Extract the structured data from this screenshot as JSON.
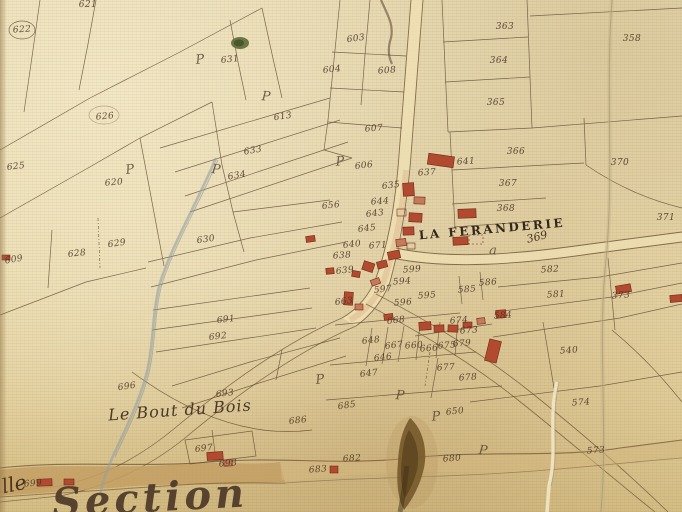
{
  "map": {
    "colors": {
      "parchment": "#e7d7a9",
      "ink": "#5f4930",
      "building_red": "#b24a30",
      "road_band": "#c9a76d",
      "stream_grey": "#93a0a4",
      "stain_brown": "#75592a",
      "foliage_green": "#5c6a36"
    },
    "region_labels": [
      {
        "name": "hamlet-label-la-feranderie",
        "t": "LA FERANDERIE",
        "x": 492,
        "y": 229,
        "r": -5,
        "kind": "caps"
      },
      {
        "name": "parcel-number-369",
        "t": "369",
        "x": 537,
        "y": 237,
        "r": -14,
        "kind": "num-lg"
      },
      {
        "name": "place-label-le-bout-du-bois",
        "t": "Le Bout du Bois",
        "x": 180,
        "y": 410,
        "r": -4,
        "kind": "script"
      },
      {
        "name": "section-label",
        "t": "Section",
        "x": 150,
        "y": 498,
        "r": -3,
        "kind": "script-xl"
      },
      {
        "name": "edge-label-lle",
        "t": "lle",
        "x": 14,
        "y": 484,
        "r": -12,
        "kind": "script-lg"
      }
    ],
    "parcel_numbers": [
      {
        "t": "622",
        "x": 22,
        "y": 30,
        "r": -4
      },
      {
        "t": "621",
        "x": 88,
        "y": 5,
        "r": 0
      },
      {
        "t": "363",
        "x": 505,
        "y": 27,
        "r": 0
      },
      {
        "t": "364",
        "x": 499,
        "y": 61,
        "r": 0
      },
      {
        "t": "365",
        "x": 496,
        "y": 103,
        "r": 0
      },
      {
        "t": "358",
        "x": 632,
        "y": 39,
        "r": 0
      },
      {
        "t": "631",
        "x": 230,
        "y": 60,
        "r": -6
      },
      {
        "t": "603",
        "x": 356,
        "y": 39,
        "r": -8
      },
      {
        "t": "604",
        "x": 332,
        "y": 70,
        "r": -6
      },
      {
        "t": "608",
        "x": 387,
        "y": 71,
        "r": -4
      },
      {
        "t": "626",
        "x": 105,
        "y": 117,
        "r": -5
      },
      {
        "t": "613",
        "x": 283,
        "y": 117,
        "r": -8
      },
      {
        "t": "607",
        "x": 374,
        "y": 129,
        "r": -5
      },
      {
        "t": "366",
        "x": 516,
        "y": 152,
        "r": 0
      },
      {
        "t": "370",
        "x": 620,
        "y": 163,
        "r": 0
      },
      {
        "t": "625",
        "x": 16,
        "y": 167,
        "r": -6
      },
      {
        "t": "620",
        "x": 114,
        "y": 183,
        "r": -5
      },
      {
        "t": "633",
        "x": 253,
        "y": 151,
        "r": -10
      },
      {
        "t": "634",
        "x": 237,
        "y": 176,
        "r": -10
      },
      {
        "t": "606",
        "x": 364,
        "y": 166,
        "r": -6
      },
      {
        "t": "367",
        "x": 508,
        "y": 184,
        "r": 0
      },
      {
        "t": "368",
        "x": 506,
        "y": 209,
        "r": 0
      },
      {
        "t": "371",
        "x": 666,
        "y": 218,
        "r": 0
      },
      {
        "t": "641",
        "x": 466,
        "y": 162,
        "r": -4
      },
      {
        "t": "637",
        "x": 427,
        "y": 173,
        "r": -4
      },
      {
        "t": "635",
        "x": 391,
        "y": 186,
        "r": -6
      },
      {
        "t": "656",
        "x": 331,
        "y": 206,
        "r": -6
      },
      {
        "t": "644",
        "x": 380,
        "y": 202,
        "r": -4
      },
      {
        "t": "643",
        "x": 375,
        "y": 214,
        "r": -6
      },
      {
        "t": "645",
        "x": 367,
        "y": 229,
        "r": -6
      },
      {
        "t": "630",
        "x": 206,
        "y": 240,
        "r": -8
      },
      {
        "t": "628",
        "x": 77,
        "y": 254,
        "r": -6
      },
      {
        "t": "629",
        "x": 117,
        "y": 244,
        "r": -8
      },
      {
        "t": "609",
        "x": 14,
        "y": 260,
        "r": -10
      },
      {
        "t": "640",
        "x": 352,
        "y": 245,
        "r": -6
      },
      {
        "t": "671",
        "x": 378,
        "y": 246,
        "r": -4
      },
      {
        "t": "638",
        "x": 342,
        "y": 256,
        "r": -4
      },
      {
        "t": "639",
        "x": 345,
        "y": 271,
        "r": -6
      },
      {
        "t": "599",
        "x": 412,
        "y": 270,
        "r": -4
      },
      {
        "t": "594",
        "x": 402,
        "y": 282,
        "r": -4
      },
      {
        "t": "597",
        "x": 383,
        "y": 290,
        "r": -6
      },
      {
        "t": "595",
        "x": 427,
        "y": 296,
        "r": -4
      },
      {
        "t": "585",
        "x": 467,
        "y": 290,
        "r": -4
      },
      {
        "t": "586",
        "x": 488,
        "y": 283,
        "r": -4
      },
      {
        "t": "596",
        "x": 403,
        "y": 303,
        "r": -4
      },
      {
        "t": "582",
        "x": 550,
        "y": 270,
        "r": -4
      },
      {
        "t": "581",
        "x": 556,
        "y": 295,
        "r": -4
      },
      {
        "t": "584",
        "x": 503,
        "y": 316,
        "r": -4
      },
      {
        "t": "373",
        "x": 621,
        "y": 296,
        "r": -4
      },
      {
        "t": "663",
        "x": 344,
        "y": 302,
        "r": -6
      },
      {
        "t": "668",
        "x": 396,
        "y": 321,
        "r": -6
      },
      {
        "t": "648",
        "x": 371,
        "y": 341,
        "r": -6
      },
      {
        "t": "667",
        "x": 394,
        "y": 346,
        "r": -6
      },
      {
        "t": "660",
        "x": 414,
        "y": 346,
        "r": -4
      },
      {
        "t": "666",
        "x": 429,
        "y": 349,
        "r": -4
      },
      {
        "t": "675",
        "x": 447,
        "y": 346,
        "r": -4
      },
      {
        "t": "679",
        "x": 462,
        "y": 344,
        "r": -4
      },
      {
        "t": "673",
        "x": 469,
        "y": 331,
        "r": -4
      },
      {
        "t": "674",
        "x": 459,
        "y": 321,
        "r": -4
      },
      {
        "t": "677",
        "x": 446,
        "y": 368,
        "r": -4
      },
      {
        "t": "678",
        "x": 468,
        "y": 378,
        "r": -4
      },
      {
        "t": "646",
        "x": 383,
        "y": 358,
        "r": -6
      },
      {
        "t": "647",
        "x": 369,
        "y": 374,
        "r": -6
      },
      {
        "t": "691",
        "x": 226,
        "y": 320,
        "r": -6
      },
      {
        "t": "692",
        "x": 218,
        "y": 337,
        "r": -6
      },
      {
        "t": "693",
        "x": 225,
        "y": 394,
        "r": -6
      },
      {
        "t": "696",
        "x": 127,
        "y": 387,
        "r": -8
      },
      {
        "t": "540",
        "x": 569,
        "y": 351,
        "r": -4
      },
      {
        "t": "574",
        "x": 581,
        "y": 403,
        "r": -4
      },
      {
        "t": "573",
        "x": 596,
        "y": 451,
        "r": -4
      },
      {
        "t": "650",
        "x": 455,
        "y": 412,
        "r": -6
      },
      {
        "t": "680",
        "x": 452,
        "y": 459,
        "r": -4
      },
      {
        "t": "685",
        "x": 347,
        "y": 406,
        "r": -8
      },
      {
        "t": "686",
        "x": 298,
        "y": 421,
        "r": -6
      },
      {
        "t": "682",
        "x": 352,
        "y": 459,
        "r": -4
      },
      {
        "t": "683",
        "x": 318,
        "y": 470,
        "r": -4
      },
      {
        "t": "697",
        "x": 204,
        "y": 449,
        "r": -6
      },
      {
        "t": "698",
        "x": 228,
        "y": 464,
        "r": -4
      },
      {
        "t": "699",
        "x": 33,
        "y": 484,
        "r": -4
      }
    ],
    "symbols": [
      {
        "g": "P",
        "x": 200,
        "y": 60,
        "r": -6
      },
      {
        "g": "P",
        "x": 266,
        "y": 97,
        "r": 4
      },
      {
        "g": "P",
        "x": 130,
        "y": 170,
        "r": -8
      },
      {
        "g": "P",
        "x": 216,
        "y": 170,
        "r": 6
      },
      {
        "g": "P",
        "x": 340,
        "y": 162,
        "r": -4
      },
      {
        "g": "P",
        "x": 320,
        "y": 380,
        "r": -6
      },
      {
        "g": "P",
        "x": 400,
        "y": 396,
        "r": 4
      },
      {
        "g": "P",
        "x": 436,
        "y": 417,
        "r": -4
      },
      {
        "g": "P",
        "x": 483,
        "y": 451,
        "r": 6
      },
      {
        "g": "a",
        "x": 493,
        "y": 251,
        "r": 0
      }
    ]
  }
}
